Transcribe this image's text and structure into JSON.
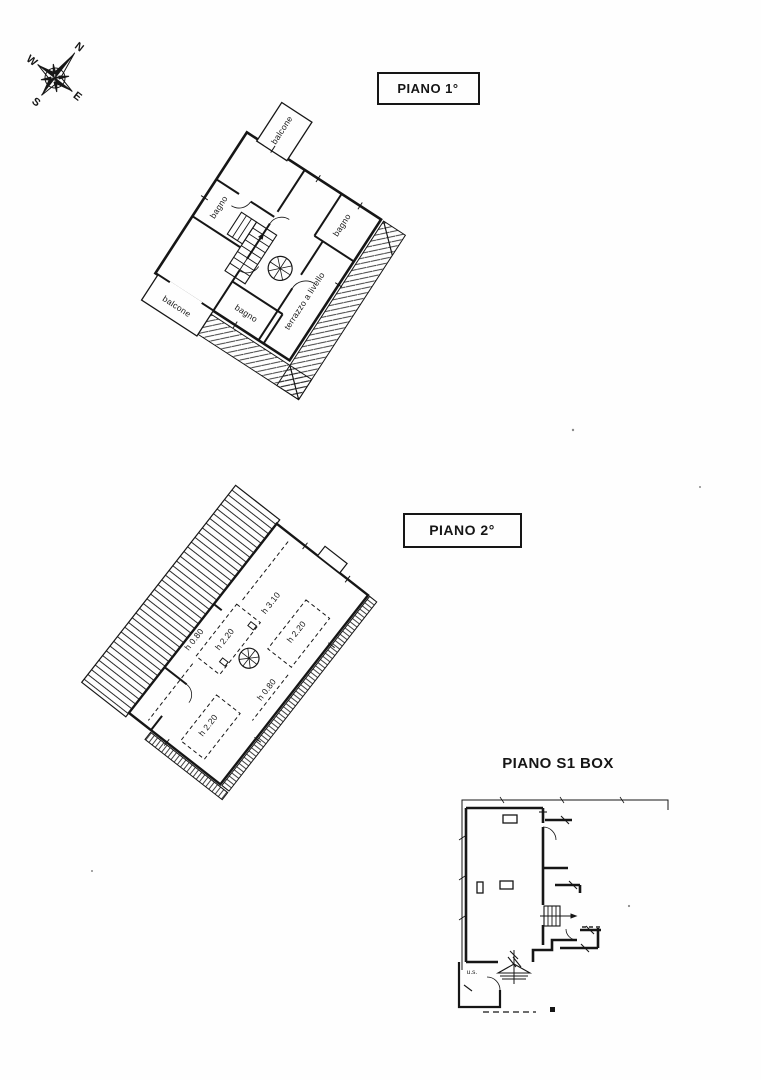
{
  "document": {
    "kind": "scanned floor plan sheet",
    "background": "#fefefe",
    "ink": "#1a1a1a"
  },
  "compass": {
    "n": "N",
    "e": "E",
    "s": "S",
    "w": "W"
  },
  "floor1": {
    "title": "PIANO 1°",
    "labels": {
      "balcone_top": "balcone",
      "bagno_top": "bagno",
      "bagno_right": "bagno",
      "balcone_left": "balcone",
      "bagno_bottom": "bagno",
      "terrazzo": "terrazzo a livello"
    }
  },
  "floor2": {
    "title": "PIANO 2°",
    "labels": {
      "h220_left": "h 2.20",
      "h310": "h 3.10",
      "h080_left": "h 0.80",
      "h220_right": "h 2.20",
      "h080_bottom": "h 0.80",
      "h220_bottom": "h 2.20"
    }
  },
  "floorS1": {
    "title": "PIANO S1 BOX",
    "labels": {
      "exit": "u.s."
    }
  }
}
